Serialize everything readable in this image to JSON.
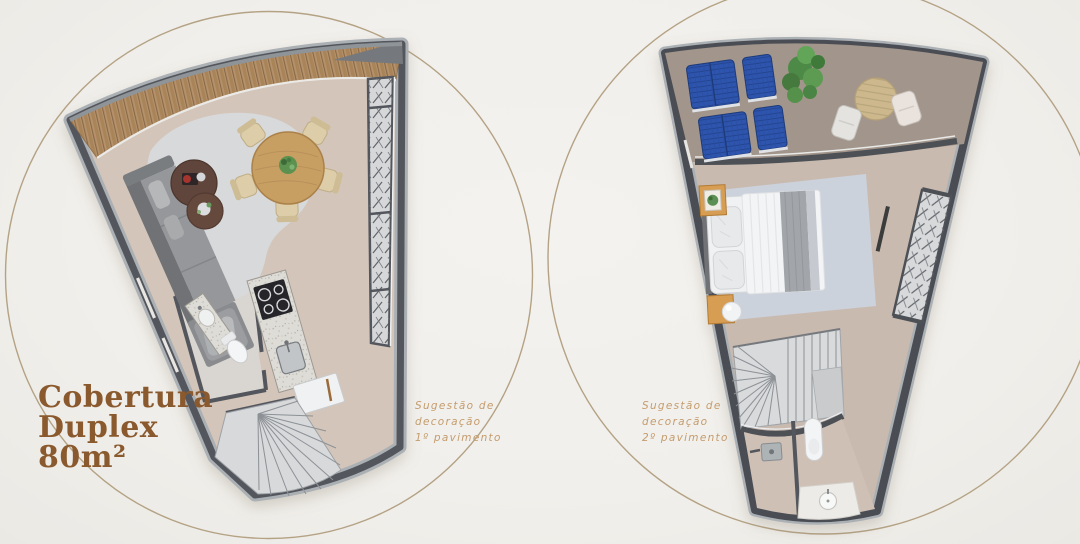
{
  "page": {
    "background_color": "#f1efeb"
  },
  "title": {
    "full_text": "Cobertura Duplex 80m²",
    "lines": [
      "Cobertura",
      "Duplex",
      "80m²"
    ],
    "color": "#8a5a2e"
  },
  "plans": [
    {
      "id": "first-floor",
      "caption_lines": [
        "Sugestão de",
        "decoração",
        "1º pavimento"
      ]
    },
    {
      "id": "second-floor",
      "caption_lines": [
        "Sugestão de",
        "decoração",
        "2º pavimento"
      ]
    }
  ],
  "caption_color": "#c49c6d",
  "decorative_circle_color": "#b4a284",
  "floorplan_palette": {
    "wall": "#53565c",
    "wall_rim": "#abb0b4",
    "floor_first": "#d3c5ba",
    "floor_second": "#c9bab0",
    "terrace_floor": "#a2958b",
    "deck_wood": "#b5916c",
    "louver_glass": "#d6d7d9",
    "rug_living": "#d8d9db",
    "rug_bedroom": "#ccd2db",
    "sofa": "#8f9194",
    "dining_wood": "#c89f63",
    "granite": "#dedcd6",
    "stairs": "#d8dadc",
    "lounger_blue": "#2e54ae",
    "plant_green": "#4e8a46",
    "bed_linen": "#eff1f3",
    "nightstand_wood": "#d79d52"
  }
}
